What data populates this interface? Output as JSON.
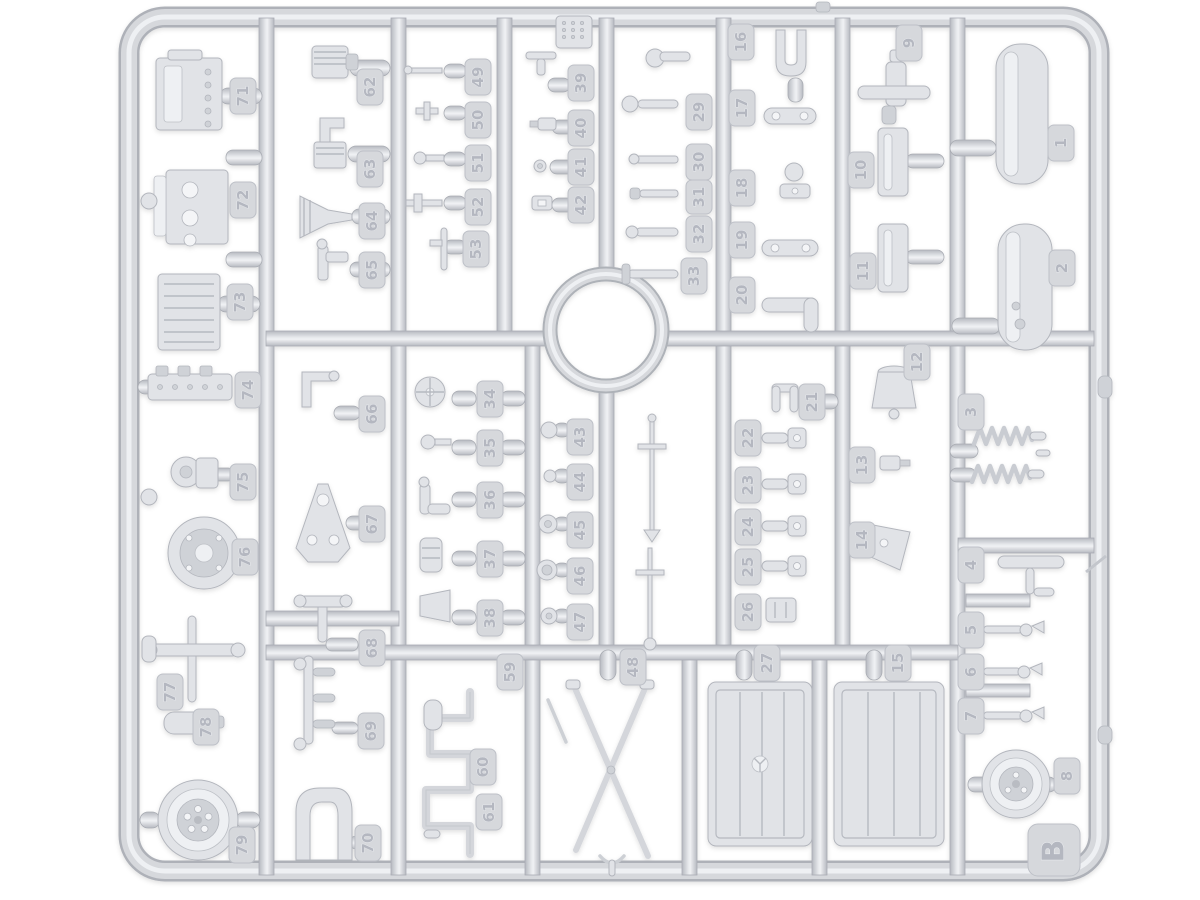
{
  "kit": {
    "sprue_letter": "B"
  },
  "colors": {
    "background": "#ffffff",
    "plastic_base": "#d6d8dc",
    "plastic_shadow": "#aeb2b8",
    "plastic_highlight": "#eef0f3",
    "tag_face": "#d6d8dc",
    "embossed_number": "#b4b7c0"
  },
  "tags": {
    "t1": "1",
    "t2": "2",
    "t3": "3",
    "t4": "4",
    "t5": "5",
    "t6": "6",
    "t7": "7",
    "t8": "8",
    "t9": "9",
    "t10": "10",
    "t11": "11",
    "t12": "12",
    "t13": "13",
    "t14": "14",
    "t15": "15",
    "t16": "16",
    "t17": "17",
    "t18": "18",
    "t19": "19",
    "t20": "20",
    "t21": "21",
    "t22": "22",
    "t23": "23",
    "t24": "24",
    "t25": "25",
    "t26": "26",
    "t27": "27",
    "t29": "29",
    "t30": "30",
    "t31": "31",
    "t32": "32",
    "t33": "33",
    "t34": "34",
    "t35": "35",
    "t36": "36",
    "t37": "37",
    "t38": "38",
    "t39": "39",
    "t40": "40",
    "t41": "41",
    "t42": "42",
    "t43": "43",
    "t44": "44",
    "t45": "45",
    "t46": "46",
    "t47": "47",
    "t48": "48",
    "t49": "49",
    "t50": "50",
    "t51": "51",
    "t52": "52",
    "t53": "53",
    "t59": "59",
    "t60": "60",
    "t61": "61",
    "t62": "62",
    "t63": "63",
    "t64": "64",
    "t65": "65",
    "t66": "66",
    "t67": "67",
    "t68": "68",
    "t69": "69",
    "t70": "70",
    "t71": "71",
    "t72": "72",
    "t73": "73",
    "t74": "74",
    "t75": "75",
    "t76": "76",
    "t77": "77",
    "t78": "78",
    "t79": "79",
    "tB": "B"
  }
}
